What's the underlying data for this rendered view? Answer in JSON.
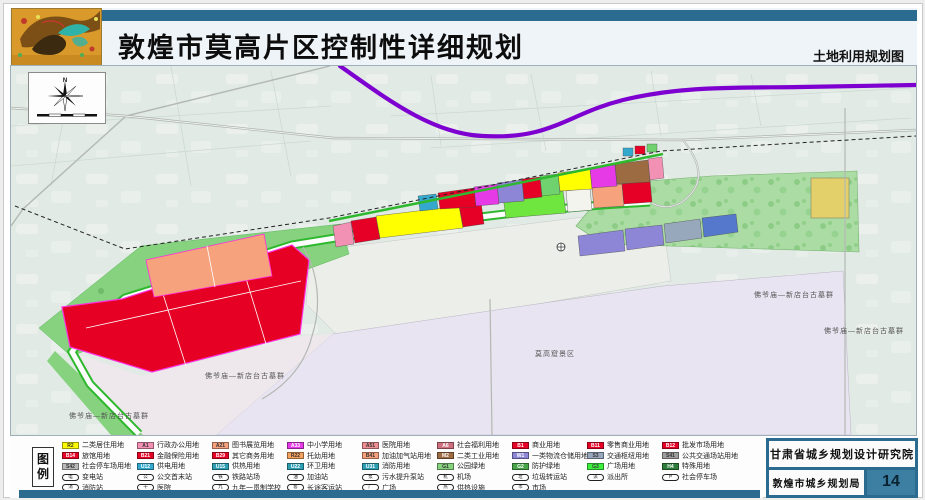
{
  "header": {
    "title": "敦煌市莫高片区控制性详细规划",
    "subtitle": "土地利用规划图"
  },
  "compass": {
    "north_label": "N"
  },
  "colors": {
    "accent_teal": "#2a6b8f",
    "expressway_purple": "#7d00d0",
    "parcel_boundary_magenta": "#ff2ddf",
    "residential_yellow": "#ffff00",
    "commercial_red": "#e60026",
    "park_green": "#86d27e"
  },
  "map": {
    "labels": [
      {
        "text": "莫高窟景区",
        "x": 553,
        "y": 352
      },
      {
        "text": "佛爷庙—新店台古墓群",
        "x": 792,
        "y": 293
      },
      {
        "text": "佛爷庙—新店台古墓群",
        "x": 862,
        "y": 329
      },
      {
        "text": "佛爷庙—新店台古墓群",
        "x": 243,
        "y": 374
      },
      {
        "text": "佛爷庙—新店台古墓群",
        "x": 107,
        "y": 414
      }
    ]
  },
  "legend": {
    "title": "图例",
    "columns": [
      {
        "items": [
          {
            "kind": "swatch",
            "code": "R2",
            "color": "#ffff00",
            "label": "二类居住用地"
          },
          {
            "kind": "swatch",
            "code": "B14",
            "color": "#e60026",
            "label": "旅馆用地"
          },
          {
            "kind": "swatch",
            "code": "S42",
            "color": "#b9b9b9",
            "label": "社会停车场用地"
          },
          {
            "kind": "icon",
            "glyph": "电",
            "label": "变电站"
          },
          {
            "kind": "icon",
            "glyph": "消",
            "label": "消防站"
          }
        ]
      },
      {
        "items": [
          {
            "kind": "swatch",
            "code": "A1",
            "color": "#f291b4",
            "label": "行政办公用地"
          },
          {
            "kind": "swatch",
            "code": "B21",
            "color": "#e60026",
            "label": "金融保险用地"
          },
          {
            "kind": "swatch",
            "code": "U12",
            "color": "#35a9cd",
            "label": "供电用地"
          },
          {
            "kind": "icon",
            "glyph": "公",
            "label": "公交首末站"
          },
          {
            "kind": "icon",
            "glyph": "十",
            "label": "医院"
          }
        ]
      },
      {
        "items": [
          {
            "kind": "swatch",
            "code": "A21",
            "color": "#f5a27d",
            "label": "图书展览用地"
          },
          {
            "kind": "swatch",
            "code": "B29",
            "color": "#e60026",
            "label": "其它商务用地"
          },
          {
            "kind": "swatch",
            "code": "U15",
            "color": "#2f9fb4",
            "label": "供热用地"
          },
          {
            "kind": "icon",
            "glyph": "铁",
            "label": "铁路站场"
          },
          {
            "kind": "icon",
            "glyph": "九",
            "label": "九年一贯制学校"
          }
        ]
      },
      {
        "items": [
          {
            "kind": "swatch",
            "code": "A33",
            "color": "#e53ae5",
            "label": "中小学用地"
          },
          {
            "kind": "swatch",
            "code": "R22",
            "color": "#f5a25e",
            "label": "托幼用地"
          },
          {
            "kind": "swatch",
            "code": "U22",
            "color": "#2f9fb4",
            "label": "环卫用地"
          },
          {
            "kind": "icon",
            "glyph": "油",
            "label": "加油站"
          },
          {
            "kind": "icon",
            "glyph": "客",
            "label": "长途客运站"
          }
        ]
      },
      {
        "items": [
          {
            "kind": "swatch",
            "code": "A51",
            "color": "#ef8f93",
            "label": "医院用地"
          },
          {
            "kind": "swatch",
            "code": "B41",
            "color": "#f5a27d",
            "label": "加油加气站用地"
          },
          {
            "kind": "swatch",
            "code": "U31",
            "color": "#2f9fb4",
            "label": "消防用地"
          },
          {
            "kind": "icon",
            "glyph": "泵",
            "label": "污水提升泵站"
          },
          {
            "kind": "icon",
            "glyph": "广",
            "label": "广场"
          }
        ]
      },
      {
        "items": [
          {
            "kind": "swatch",
            "code": "A6",
            "color": "#cd6f7e",
            "label": "社会福利用地"
          },
          {
            "kind": "swatch",
            "code": "M2",
            "color": "#9c6b42",
            "label": "二类工业用地"
          },
          {
            "kind": "swatch",
            "code": "G1",
            "color": "#86d27e",
            "label": "公园绿地"
          },
          {
            "kind": "icon",
            "glyph": "机",
            "label": "机场"
          },
          {
            "kind": "icon",
            "glyph": "热",
            "label": "供热设施"
          }
        ]
      },
      {
        "items": [
          {
            "kind": "swatch",
            "code": "B1",
            "color": "#e60026",
            "label": "商业用地"
          },
          {
            "kind": "swatch",
            "code": "W1",
            "color": "#8d85d6",
            "label": "一类物流仓储用地"
          },
          {
            "kind": "swatch",
            "code": "G2",
            "color": "#4aa54a",
            "label": "防护绿地"
          },
          {
            "kind": "icon",
            "glyph": "垃",
            "label": "垃圾转运站"
          },
          {
            "kind": "icon",
            "glyph": "市",
            "label": "市场"
          }
        ]
      },
      {
        "items": [
          {
            "kind": "swatch",
            "code": "B11",
            "color": "#e60026",
            "label": "零售商业用地"
          },
          {
            "kind": "swatch",
            "code": "S3",
            "color": "#98a8bc",
            "label": "交通枢纽用地"
          },
          {
            "kind": "swatch",
            "code": "G3",
            "color": "#3ef03e",
            "label": "广场用地"
          },
          {
            "kind": "icon",
            "glyph": "派",
            "label": "派出所"
          }
        ]
      },
      {
        "items": [
          {
            "kind": "swatch",
            "code": "B12",
            "color": "#e60026",
            "label": "批发市场用地"
          },
          {
            "kind": "swatch",
            "code": "S41",
            "color": "#9e9e9e",
            "label": "公共交通场站用地"
          },
          {
            "kind": "swatch",
            "code": "H4",
            "color": "#2f7d3a",
            "label": "特殊用地"
          },
          {
            "kind": "icon",
            "glyph": "P",
            "label": "社会停车场"
          }
        ]
      }
    ]
  },
  "footer": {
    "institute": "甘肃省城乡规划设计研究院",
    "bureau": "敦煌市城乡规划局",
    "page_number": "14"
  }
}
